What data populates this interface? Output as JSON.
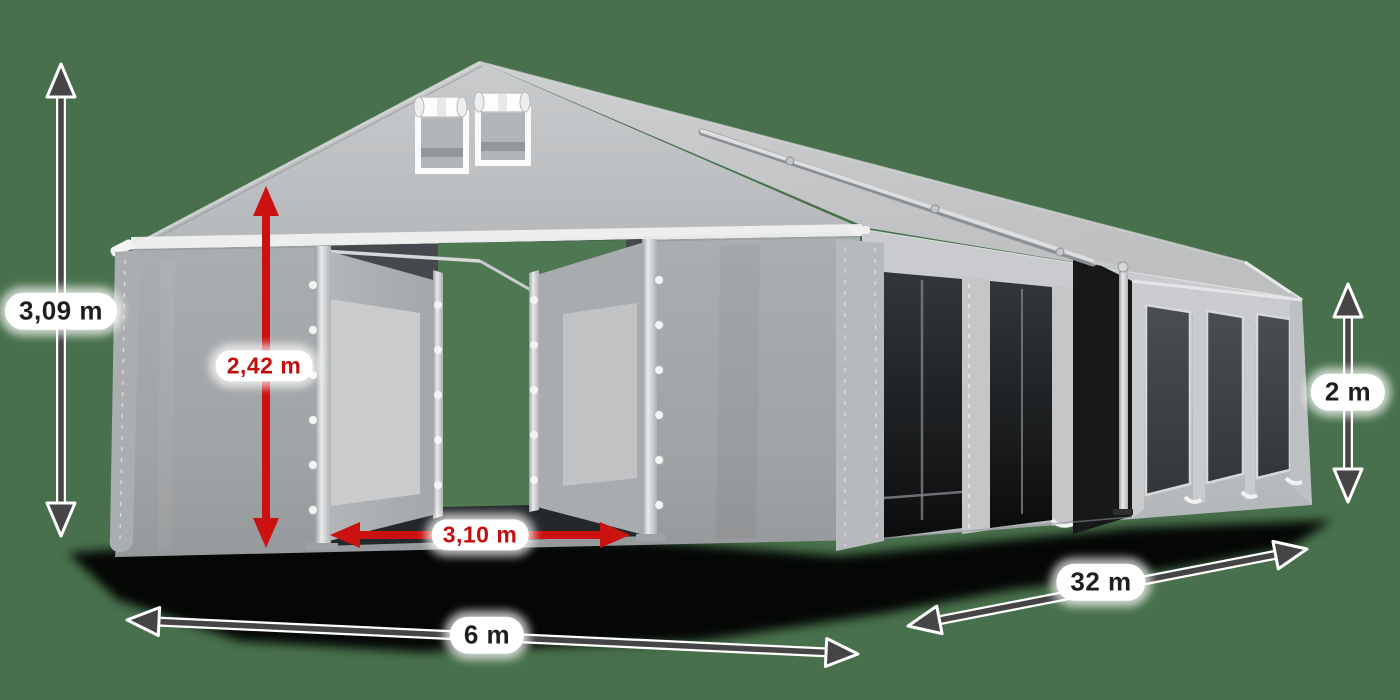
{
  "scene": {
    "subject": "Gray PVC marquee storage tent, 3D product render with dimension arrows",
    "background_color": "#48704c"
  },
  "dimensions": {
    "total_height": {
      "label": "3,09 m"
    },
    "door_height": {
      "label": "2,42 m"
    },
    "door_width": {
      "label": "3,10 m"
    },
    "front_width": {
      "label": "6 m"
    },
    "length": {
      "label": "32 m"
    },
    "side_height": {
      "label": "2 m"
    }
  },
  "colors": {
    "background": "#48704c",
    "arrow_dark": "#454545",
    "arrow_red": "#cc1111",
    "label_background": "#ffffff",
    "label_dark_text": "#1f1f1f",
    "label_red_text": "#c40f0f",
    "tent_fabric_light": "#c6c8ca",
    "tent_fabric_mid": "#a9acae"
  }
}
